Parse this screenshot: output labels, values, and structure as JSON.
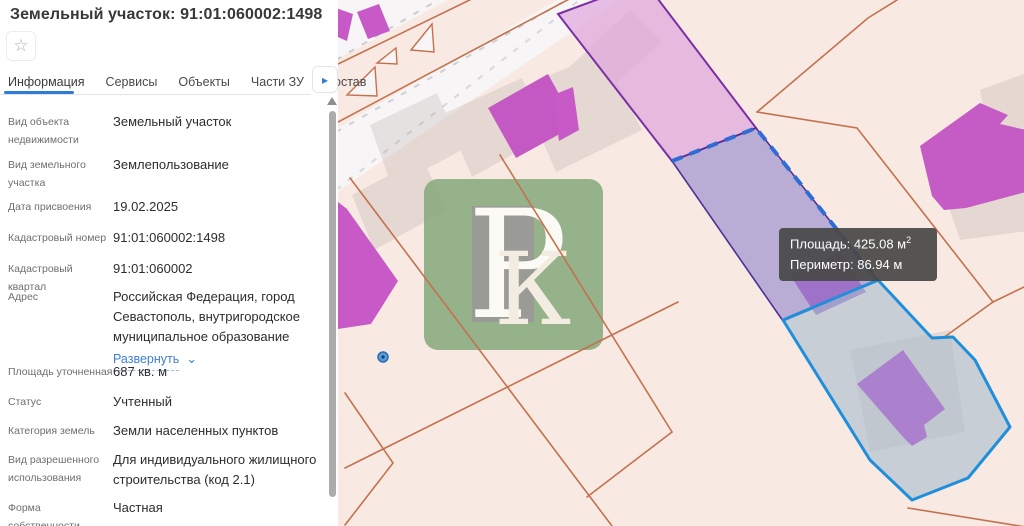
{
  "panel": {
    "title": "Земельный участок: 91:01:060002:1498",
    "tabs": [
      {
        "label": "Информация",
        "active": true
      },
      {
        "label": "Сервисы",
        "active": false
      },
      {
        "label": "Объекты",
        "active": false
      },
      {
        "label": "Части ЗУ",
        "active": false
      },
      {
        "label": "Состав",
        "active": false
      }
    ],
    "fields": [
      {
        "label": "Вид объекта недвижимости",
        "value": "Земельный участок"
      },
      {
        "label": "Вид земельного участка",
        "value": "Землепользование"
      },
      {
        "label": "Дата присвоения",
        "value": "19.02.2025"
      },
      {
        "label": "Кадастровый номер",
        "value": "91:01:060002:1498"
      },
      {
        "label": "Кадастровый квартал",
        "value": "91:01:060002"
      },
      {
        "label": "Адрес",
        "value": "Российская Федерация, город Севастополь, внутригородское муниципальное образование",
        "link": "Развернуть"
      },
      {
        "label": "Площадь уточненная",
        "value": "687 кв. м"
      },
      {
        "label": "Статус",
        "value": "Учтенный"
      },
      {
        "label": "Категория земель",
        "value": "Земли населенных пунктов"
      },
      {
        "label": "Вид разрешенного использования",
        "value": "Для индивидуального жилищного строительства (код 2.1)"
      },
      {
        "label": "Форма собственности",
        "value": "Частная"
      }
    ],
    "icons": {
      "favorite_star": "☆",
      "more_tabs_arrow": "▸",
      "expand_chevron": "⌄"
    }
  },
  "map": {
    "tooltip": {
      "area": "Площадь: 425.08 м",
      "area_sup": "2",
      "perimeter": "Периметр: 86.94 м"
    },
    "watermark": {
      "letter_p": "Р",
      "letter_k": "К"
    },
    "colors": {
      "map_background": "#f8e9e3",
      "parcel_line_orange": "#c4714e",
      "building_magenta": "#c75ac7",
      "selected_parcel_fill": "#b3aadb",
      "selected_parcel_dash": "#2f6cd5",
      "neighbor_parcel_pink": "#dfa8dc",
      "blue_parcel_outline": "#1f8fdb",
      "accent_blue": "#2f7cd6",
      "tooltip_background": "#484848",
      "watermark_green": "#86a97b"
    }
  }
}
